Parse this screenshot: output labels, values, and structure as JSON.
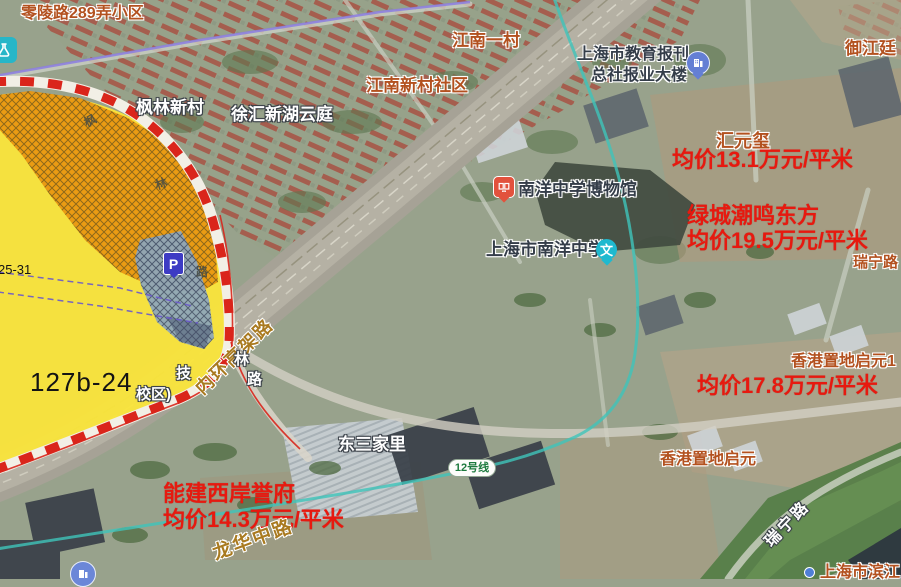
{
  "pois": {
    "lingling_community": "零陵路289弄小区",
    "fenglin_estate": "枫林新村",
    "xuhui_xinhu_yunting": "徐汇新湖云庭",
    "jiangnan_first_village": "江南一村",
    "jiangnan_community": "江南新村社区",
    "education_press_line1": "上海市教育报刊",
    "education_press_line2": "总社报业大楼",
    "yujiangting": "御江廷",
    "huiyuanxi": "汇元玺",
    "lvcheng_chaoming": "绿城潮鸣东方",
    "nanyang_museum": "南洋中学博物馆",
    "nanyang_school": "上海市南洋中学",
    "hk_land_qiyuan_phase": "香港置地启元1",
    "hk_land_qiyuan": "香港置地启元",
    "dongsanjiali": "东三家里",
    "nengjian_west_bund": "能建西岸誉府",
    "binjiang_partial": "上海市滨江"
  },
  "prices": {
    "huiyuanxi": "均价13.1万元/平米",
    "lvcheng": "均价19.5万元/平米",
    "hk_land": "均价17.8万元/平米",
    "nengjian": "均价14.3万元/平米"
  },
  "roads": {
    "elevated_road": "内环高架路",
    "longhua_middle_road": "龙华中路",
    "ruining_road_diagonal": "瑞宁路",
    "ruining_road_edge": "瑞宁路",
    "fenglin_char1": "枫",
    "fenglin_char2": "林",
    "fenglin_char3": "路",
    "fenglin_lower_char1": "林",
    "fenglin_lower_char2": "路"
  },
  "parcels": {
    "main_parcel": "127b-24",
    "small_parcel": "25-31",
    "partial_school_line1": "技",
    "partial_school_line2": "校区)"
  },
  "transit": {
    "line12_badge": "12号线"
  },
  "icons": {
    "parking": "P",
    "school_pin": "文"
  },
  "colors": {
    "parcel_yellow": "#f9e43b",
    "hatch_orange": "#e9940f",
    "hatch_blue": "#8ea6b8",
    "boundary_red": "#da251b",
    "metro_teal": "#3fc4ba",
    "tram_purple": "#8b7de0",
    "price_red": "#e7190f",
    "poi_orange": "#b3511f",
    "road_label_orange": "#a97a20",
    "parking_blue": "#3d3bc4"
  }
}
